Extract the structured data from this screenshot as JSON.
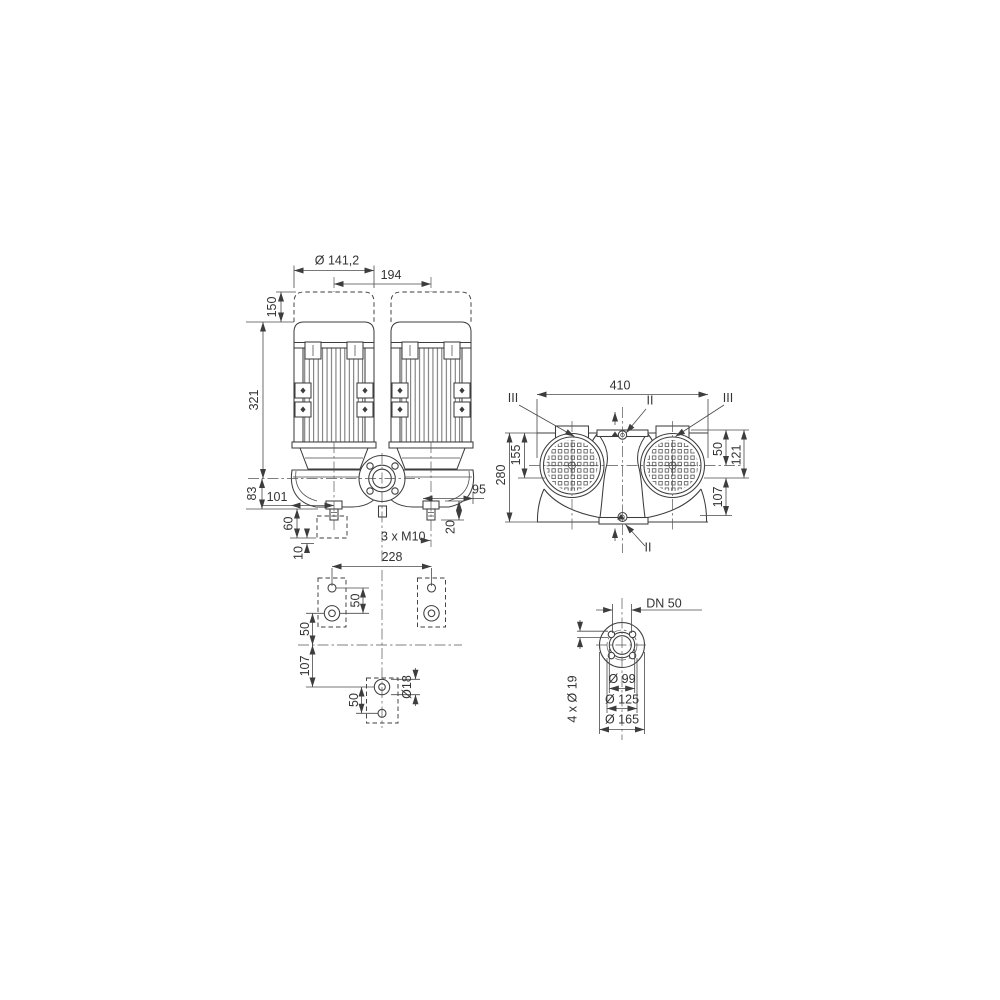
{
  "front": {
    "motor_dia": "Ø 141,2",
    "motor_spacing": "194",
    "demount_clearance": "150",
    "motor_height": "321",
    "base_height": "83",
    "left_offset": "101",
    "right_offset": "95",
    "foot_block": "60",
    "grout": "10",
    "stud": "20",
    "thread": "3 x M10"
  },
  "plan": {
    "span": "228",
    "hole_gap_top": "50",
    "center_offset": "50",
    "rear_offset": "107",
    "hole_gap_bottom": "50",
    "hole_dia": "Ø18"
  },
  "top": {
    "width": "410",
    "depth": "280",
    "front_depth": "155",
    "motor_axis": "50",
    "pipe_axis": "121",
    "rear_depth": "107",
    "sec_left": "III",
    "sec_top": "II",
    "sec_right": "III",
    "sec_bottom": "II"
  },
  "flange": {
    "dn": "DN 50",
    "bolts": "4 x Ø 19",
    "d_face": "Ø 99",
    "d_bolt_circle": "Ø 125",
    "d_outer": "Ø 165"
  }
}
